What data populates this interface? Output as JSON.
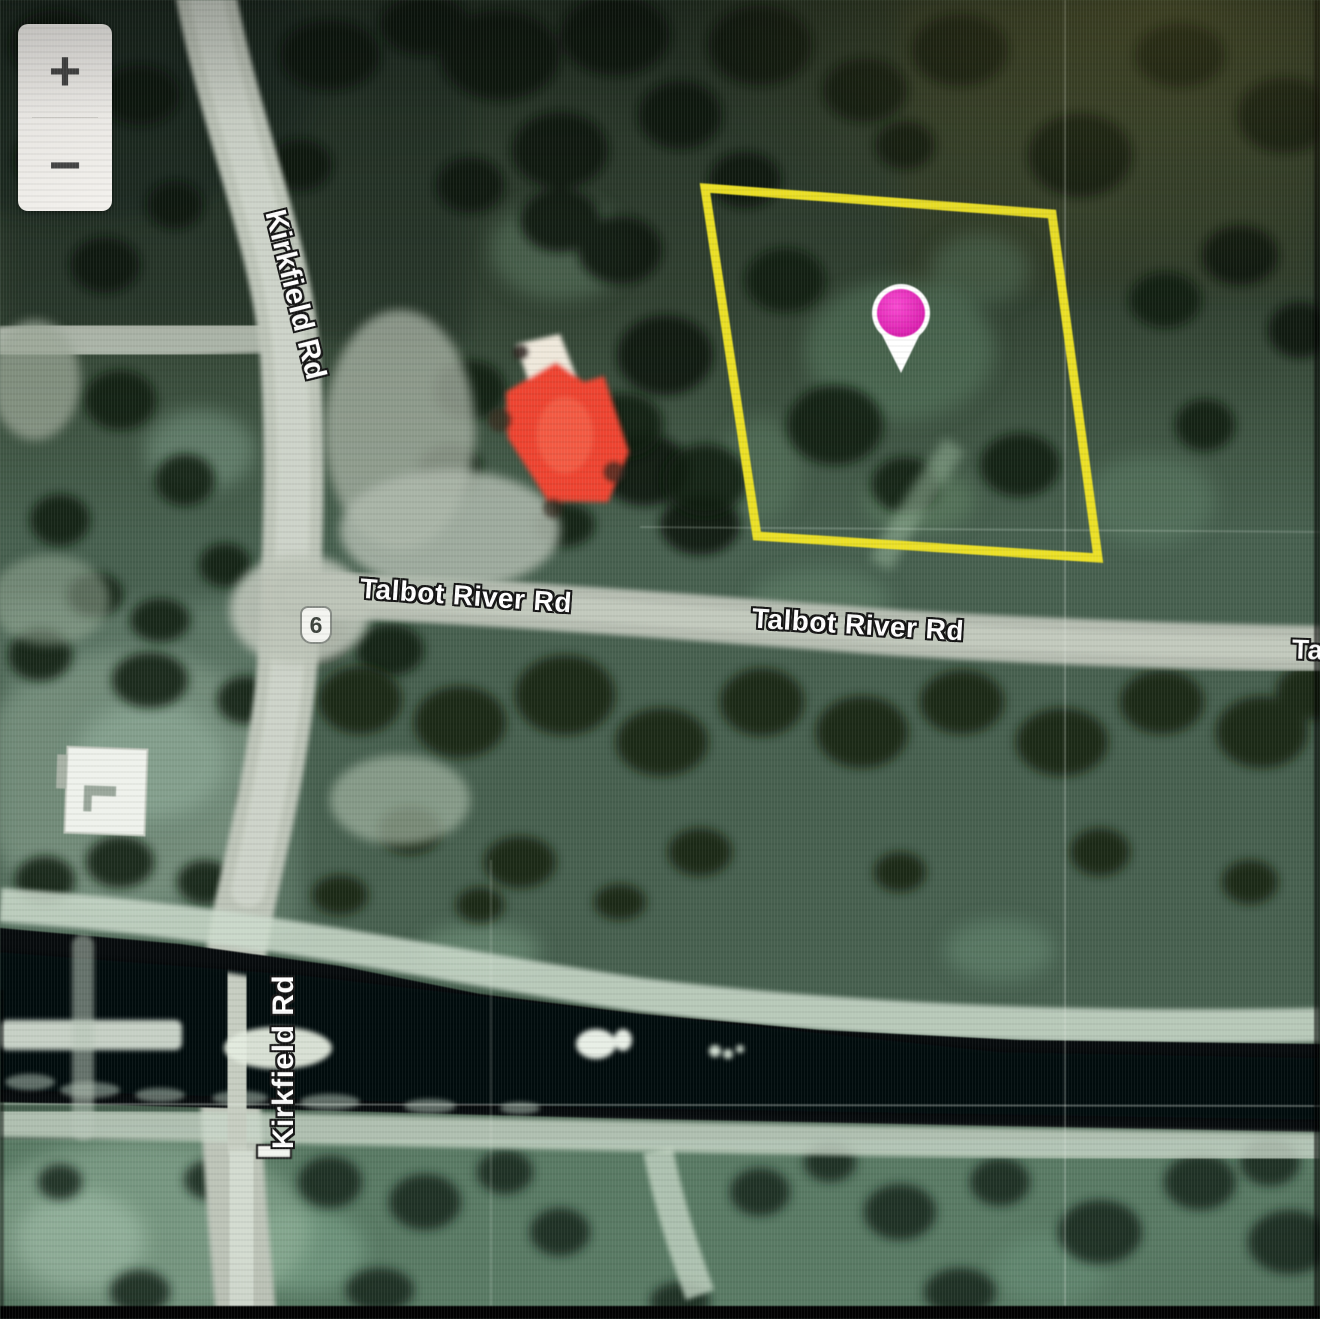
{
  "map": {
    "controls": {
      "zoom_in": "+",
      "zoom_out": "−"
    },
    "labels": {
      "kirkfield_top": "Kirkfield Rd",
      "kirkfield_bottom": "Kirkfield Rd",
      "talbot_left": "Talbot River Rd",
      "talbot_right": "Talbot River Rd",
      "talbot_truncated": "Ta",
      "route_badge": "6"
    },
    "overlay": {
      "boundary_color": "#f2e51d",
      "marker_color": "#ea1bc6"
    }
  }
}
